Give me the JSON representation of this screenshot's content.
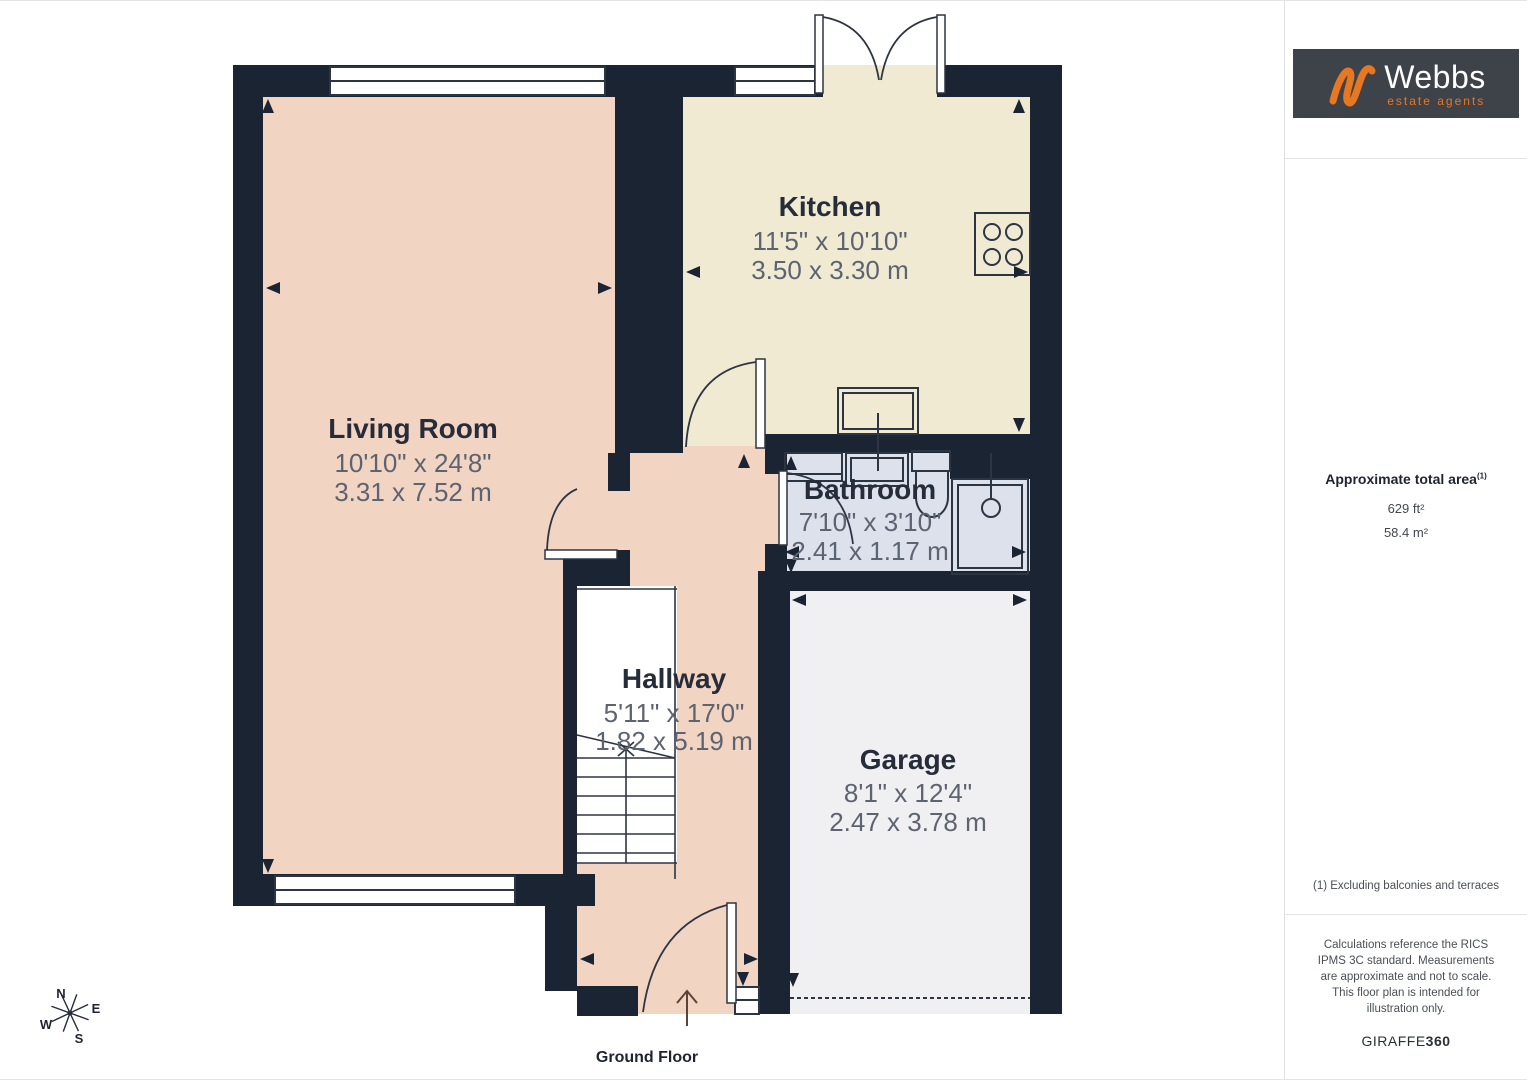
{
  "floor_plan": {
    "floor_label": "Ground Floor",
    "compass": {
      "north": "N",
      "east": "E",
      "south": "S",
      "west": "W"
    },
    "rooms": [
      {
        "name": "Living Room",
        "imperial": "10'10\" x 24'8\"",
        "metric": "3.31 x 7.52 m"
      },
      {
        "name": "Kitchen",
        "imperial": "11'5\" x 10'10\"",
        "metric": "3.50 x 3.30 m"
      },
      {
        "name": "Bathroom",
        "imperial": "7'10\" x 3'10\"",
        "metric": "2.41 x 1.17 m"
      },
      {
        "name": "Hallway",
        "imperial": "5'11\" x 17'0\"",
        "metric": "1.82 x 5.19 m"
      },
      {
        "name": "Garage",
        "imperial": "8'1\" x 12'4\"",
        "metric": "2.47 x 3.78 m"
      }
    ]
  },
  "sidebar": {
    "logo": {
      "brand": "Webbs",
      "tagline": "estate agents"
    },
    "area_title": "Approximate total area",
    "area_superscript": "(1)",
    "area_imperial": "629 ft²",
    "area_metric": "58.4 m²",
    "footnote": "(1) Excluding balconies and terraces",
    "disclaimer": "Calculations reference the RICS IPMS 3C standard. Measurements are approximate and not to scale. This floor plan is intended for illustration only.",
    "credit_brand": "GIRAFFE",
    "credit_suffix": "360"
  },
  "colors": {
    "wall": "#1b2432",
    "living_hallway": "#f2d4c3",
    "kitchen": "#f0ead3",
    "bathroom": "#dde1ec",
    "garage": "#f0f0f2",
    "accent_orange": "#e87722"
  }
}
